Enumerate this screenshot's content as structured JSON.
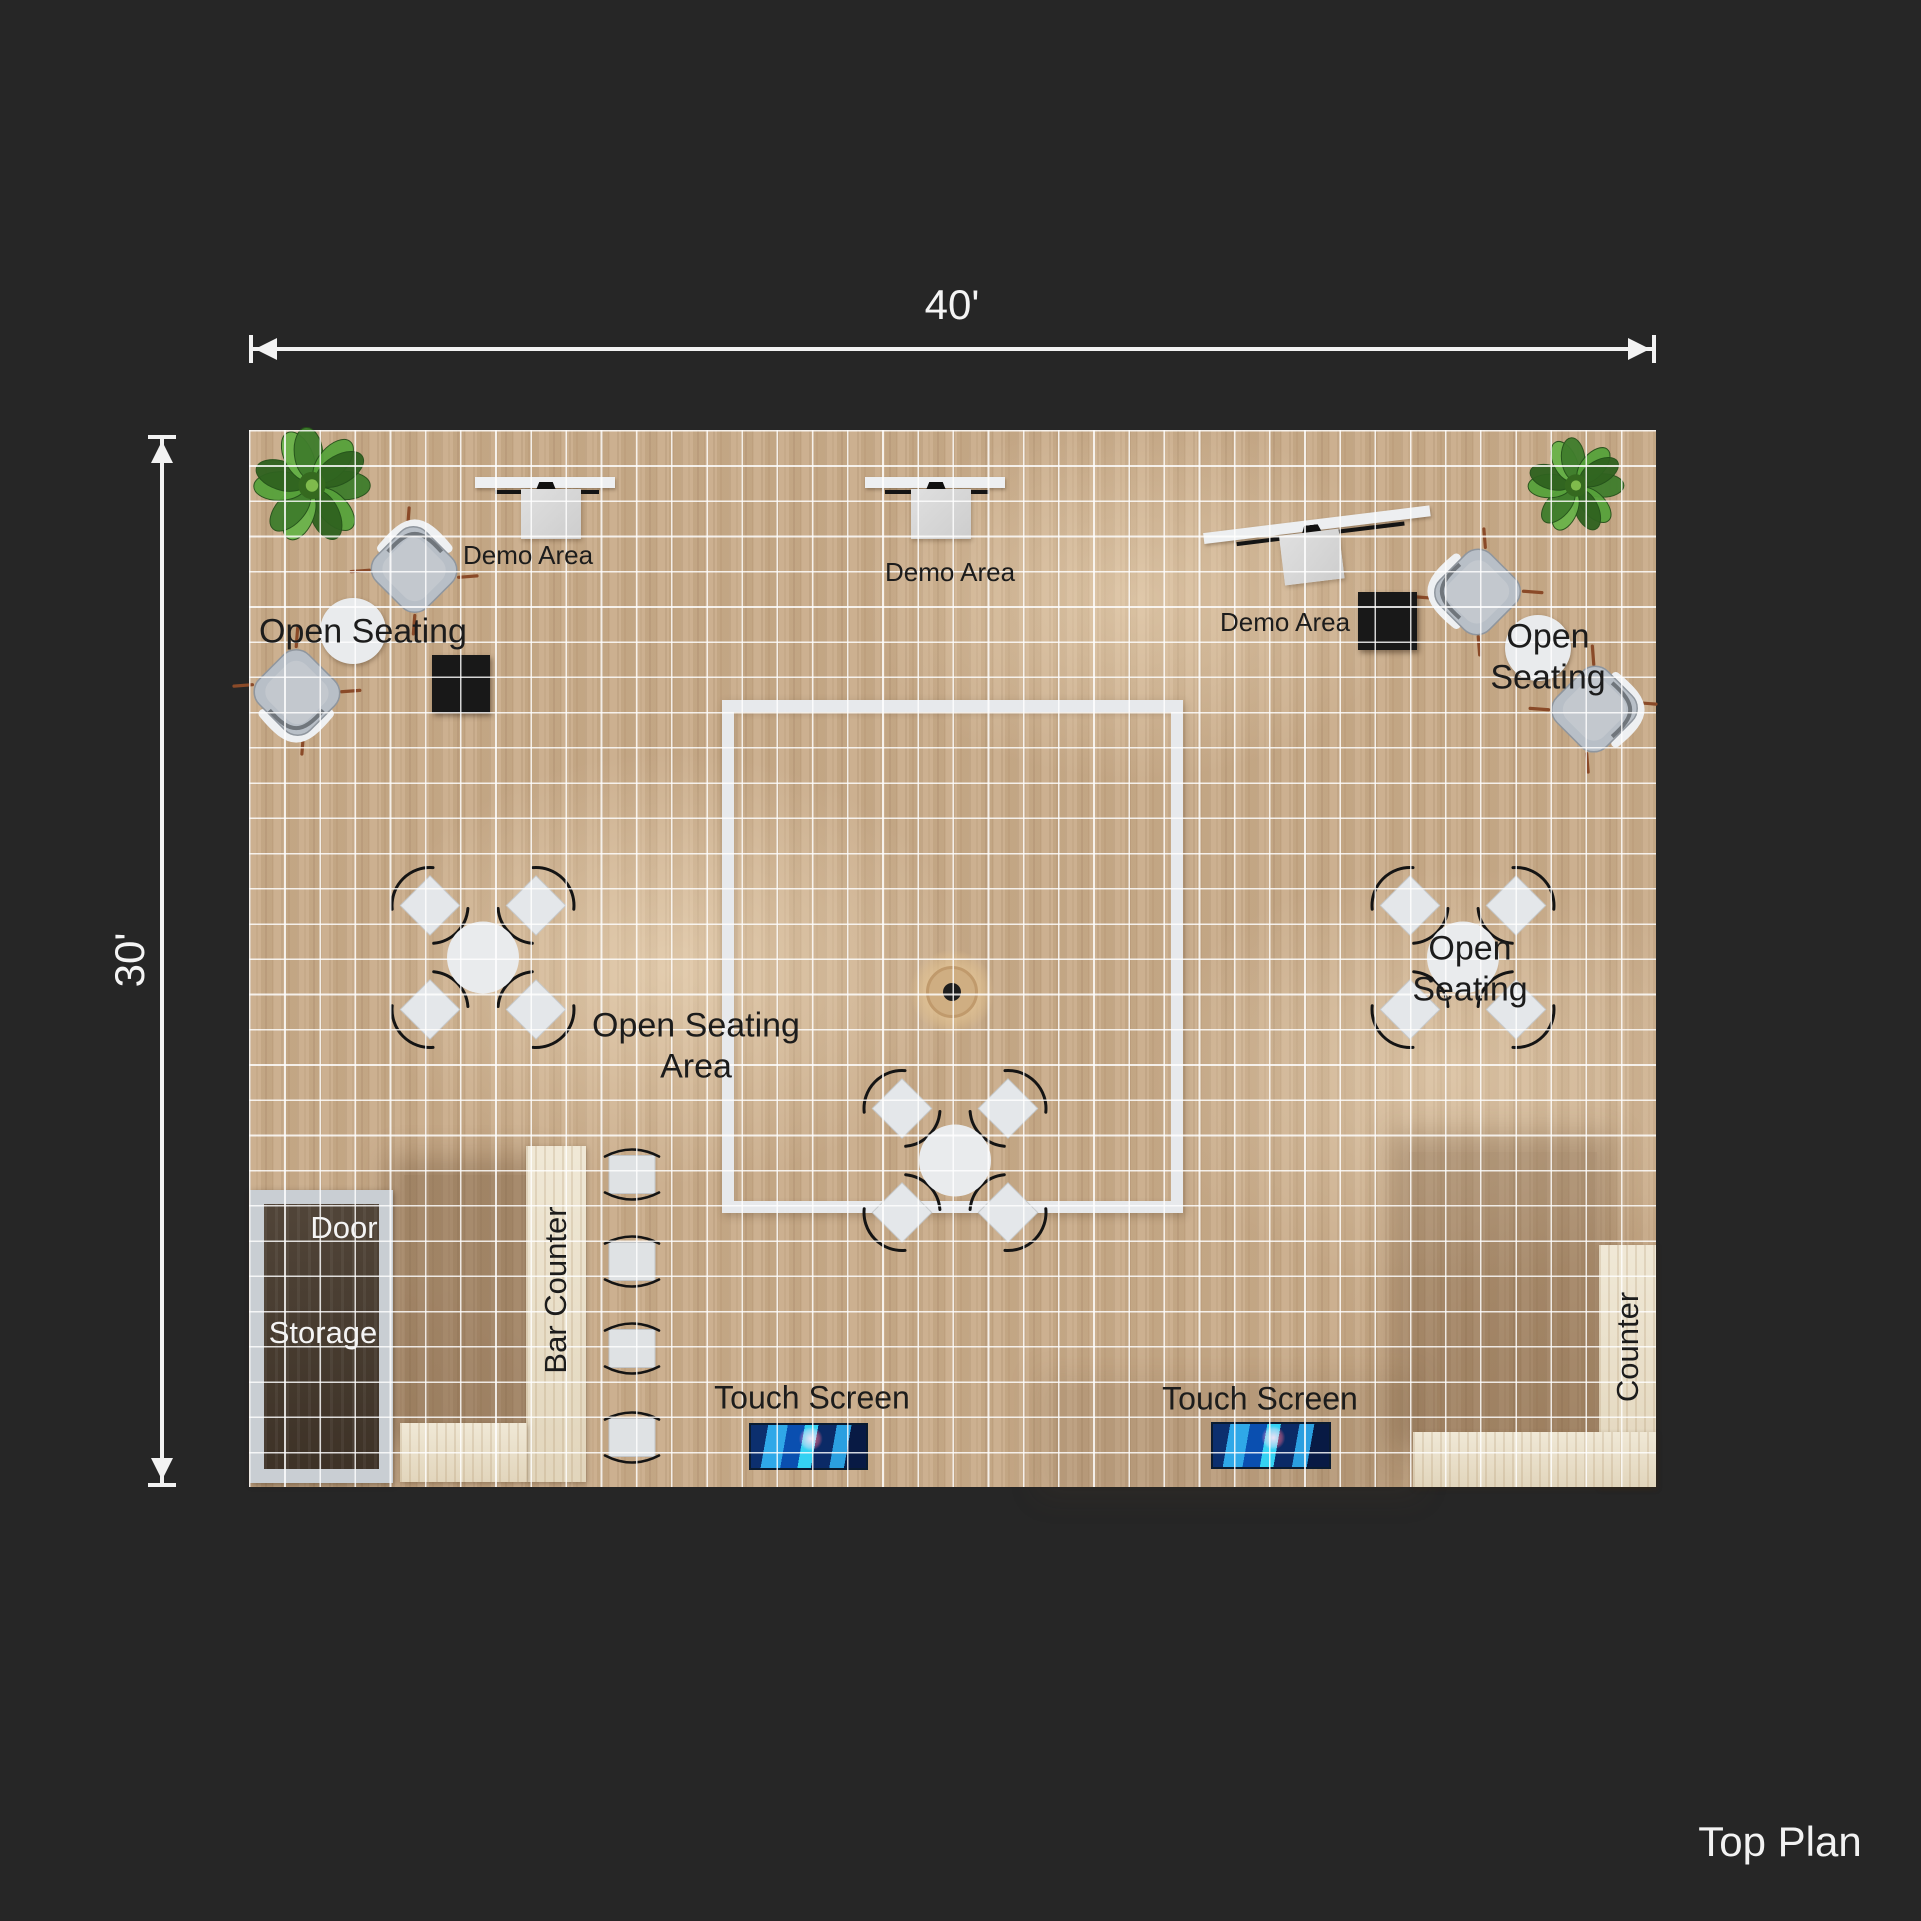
{
  "title": {
    "top_plan": "Top Plan"
  },
  "dimensions": {
    "width_label": "40'",
    "height_label": "30'"
  },
  "colors": {
    "background": "#262626",
    "floor_wood": "#c9ac8a",
    "grid_line": "#ffffff",
    "inner_square_outline": "#e7e9ec",
    "counter_beige": "#ebe1c9",
    "storage_dark": "#46392c",
    "storage_frame": "#c9ced3",
    "black_table": "#181818",
    "screen_blue": "#1a7fd4",
    "plant_green": "#4c8a33",
    "label_dark": "#1c1c1c",
    "label_white": "#f4f4f4"
  },
  "floorplan": {
    "size_ft": {
      "width": 40,
      "height": 30
    },
    "labels": [
      {
        "id": "demo-area-1",
        "text": "Demo Area",
        "x": 279,
        "y": 126,
        "size": 26
      },
      {
        "id": "demo-area-2",
        "text": "Demo Area",
        "x": 701,
        "y": 143,
        "size": 26
      },
      {
        "id": "demo-area-3",
        "text": "Demo Area",
        "x": 1036,
        "y": 193,
        "size": 26
      },
      {
        "id": "open-seating-1",
        "text": "Open Seating",
        "x": 114,
        "y": 202,
        "size": 34
      },
      {
        "id": "open-seating-2",
        "text": "Open Seating",
        "x": 1299,
        "y": 228,
        "size": 34
      },
      {
        "id": "open-seating-3",
        "text": "Open Seating",
        "x": 1221,
        "y": 540,
        "size": 34
      },
      {
        "id": "open-seating-area",
        "text": "Open Seating\nArea",
        "x": 447,
        "y": 617,
        "size": 34
      },
      {
        "id": "door",
        "text": "Door",
        "x": 95,
        "y": 798,
        "size": 31,
        "white": true
      },
      {
        "id": "storage",
        "text": "Storage",
        "x": 74,
        "y": 903,
        "size": 31,
        "white": true
      },
      {
        "id": "bar-counter",
        "text": "Bar Counter",
        "x": 307,
        "y": 860,
        "size": 31,
        "vert": true
      },
      {
        "id": "counter",
        "text": "Counter",
        "x": 1379,
        "y": 917,
        "size": 31,
        "vert": true
      },
      {
        "id": "touch-screen-1",
        "text": "Touch Screen",
        "x": 563,
        "y": 968,
        "size": 32
      },
      {
        "id": "touch-screen-2",
        "text": "Touch Screen",
        "x": 1011,
        "y": 969,
        "size": 32
      }
    ],
    "furniture": [
      {
        "id": "shade-bar-area",
        "type": "shade",
        "x": 155,
        "y": 745,
        "w": 125,
        "h": 250,
        "c": "rgba(92,64,38,0.33)"
      },
      {
        "id": "shade-right-counter",
        "type": "shade",
        "x": 1160,
        "y": 722,
        "w": 188,
        "h": 278,
        "c": "rgba(92,64,38,0.28)"
      },
      {
        "id": "shade-bottom-right",
        "type": "shade",
        "x": 805,
        "y": 960,
        "w": 350,
        "h": 90,
        "c": "rgba(92,64,38,0.12)"
      },
      {
        "id": "plant-top-left",
        "type": "plant",
        "cx": 63,
        "cy": 58,
        "d": 124
      },
      {
        "id": "plant-top-right",
        "type": "plant",
        "cx": 1327,
        "cy": 58,
        "d": 102
      },
      {
        "id": "inner-square",
        "type": "bigsquare",
        "x": 473,
        "y": 270,
        "w": 461,
        "h": 513
      },
      {
        "id": "floor-knot",
        "type": "knot",
        "cx": 703,
        "cy": 562
      },
      {
        "id": "storage-room",
        "type": "storage",
        "x": 1,
        "y": 760,
        "w": 143,
        "h": 293
      },
      {
        "id": "bar-counter-top",
        "type": "counter",
        "x": 277,
        "y": 716,
        "w": 60,
        "h": 336
      },
      {
        "id": "bar-counter-ext",
        "type": "counter",
        "x": 151,
        "y": 993,
        "w": 127,
        "h": 59
      },
      {
        "id": "right-counter-vert",
        "type": "counter",
        "x": 1350,
        "y": 815,
        "w": 57,
        "h": 242
      },
      {
        "id": "right-counter-horiz",
        "type": "counter",
        "x": 1164,
        "y": 1002,
        "w": 243,
        "h": 55
      },
      {
        "id": "touch-screen-display-1",
        "type": "screen",
        "x": 500,
        "y": 993,
        "w": 115,
        "h": 43
      },
      {
        "id": "touch-screen-display-2",
        "type": "screen",
        "x": 962,
        "y": 992,
        "w": 116,
        "h": 43
      },
      {
        "id": "demo-desk-1",
        "type": "desk",
        "x": 226,
        "y": 47,
        "w": 140
      },
      {
        "id": "demo-desk-2",
        "type": "desk",
        "x": 616,
        "y": 47,
        "w": 140
      },
      {
        "id": "demo-desk-3",
        "type": "desk",
        "cx": 1071,
        "cy": 120,
        "w": 228,
        "rot": -7
      },
      {
        "id": "lounge-chair-a",
        "type": "duochair",
        "cx": 164,
        "cy": 142,
        "rot": 45
      },
      {
        "id": "lounge-chair-b",
        "type": "duochair",
        "cx": 49,
        "cy": 260,
        "rot": -135
      },
      {
        "id": "lounge-chair-c",
        "type": "duochair",
        "cx": 1231,
        "cy": 163,
        "rot": -45
      },
      {
        "id": "lounge-chair-d",
        "type": "duochair",
        "cx": 1343,
        "cy": 278,
        "rot": 135
      },
      {
        "id": "duo-table-left",
        "type": "duotable",
        "cx": 104,
        "cy": 201,
        "r": 33
      },
      {
        "id": "duo-table-right",
        "type": "duotable",
        "cx": 1289,
        "cy": 218,
        "r": 33
      },
      {
        "id": "black-table-left",
        "type": "blacksq",
        "x": 183,
        "y": 225,
        "w": 58,
        "h": 58
      },
      {
        "id": "black-table-right",
        "type": "blacksq",
        "x": 1109,
        "y": 162,
        "w": 59,
        "h": 58
      },
      {
        "id": "seating-cluster-left",
        "type": "cluster",
        "cx": 234,
        "cy": 530
      },
      {
        "id": "seating-cluster-right",
        "type": "cluster",
        "cx": 1214,
        "cy": 530
      },
      {
        "id": "seating-cluster-bottom",
        "type": "cluster",
        "cx": 706,
        "cy": 733
      },
      {
        "id": "bar-stool-1",
        "type": "stool",
        "cx": 383,
        "cy": 747
      },
      {
        "id": "bar-stool-2",
        "type": "stool",
        "cx": 383,
        "cy": 834
      },
      {
        "id": "bar-stool-3",
        "type": "stool",
        "cx": 383,
        "cy": 921
      },
      {
        "id": "bar-stool-4",
        "type": "stool",
        "cx": 383,
        "cy": 1010
      }
    ]
  }
}
